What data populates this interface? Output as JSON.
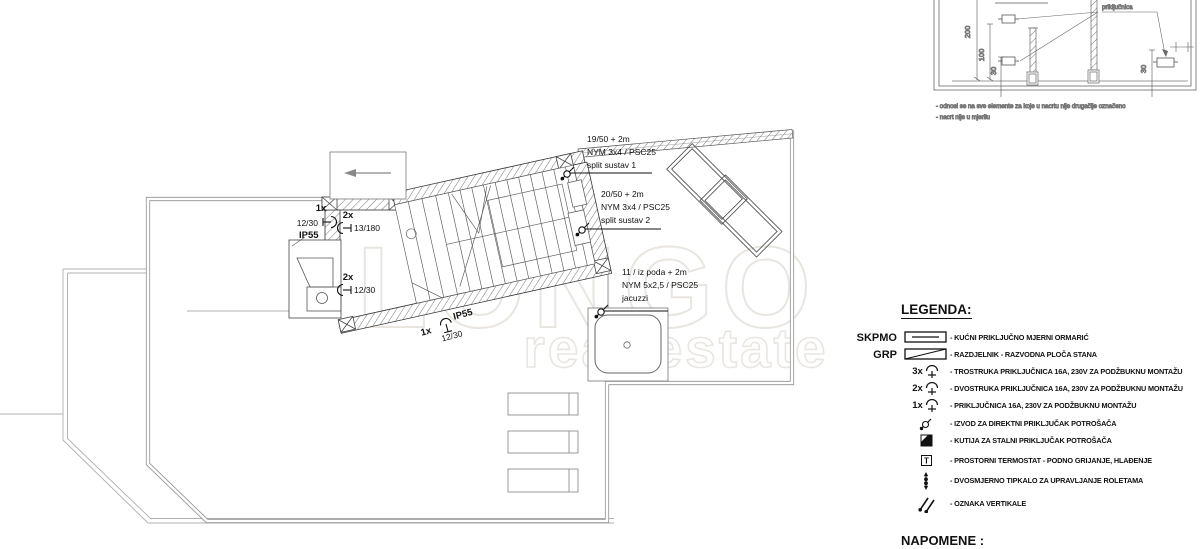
{
  "colors": {
    "line": "#444444",
    "terrace_edge": "#909090",
    "watermark": "#e9e6e1",
    "hatch": "#666666"
  },
  "watermark": {
    "line1": "LONGO",
    "line2": "real estate"
  },
  "plan": {
    "sockets": [
      {
        "count": "1x",
        "dim": "12/30",
        "ip": "IP55"
      },
      {
        "count": "2x",
        "dim": "13/180"
      },
      {
        "count": "2x",
        "dim": "12/30"
      },
      {
        "count": "1x",
        "dim": "12/30",
        "ip": "IP55"
      }
    ],
    "annotations": [
      {
        "l1": "19/50 + 2m",
        "l2": "NYM 3x4 / PSC25",
        "l3": "split sustav 1"
      },
      {
        "l1": "20/50 + 2m",
        "l2": "NYM 3x4 / PSC25",
        "l3": "split sustav 2"
      },
      {
        "l1": "11 / iz poda + 2m",
        "l2": "NYM 5x2,5 / PSC25",
        "l3": "jacuzzi"
      }
    ]
  },
  "detail": {
    "label_prikljucnica": "priključnica",
    "dims": {
      "d200": "200",
      "d100": "100",
      "d30_left": "30",
      "d30_right": "30"
    },
    "notes": [
      "- odnosi se na sve elemente za koje u nacrtu nije drugačije označeno",
      "- nacrt nije u mjerilu"
    ]
  },
  "legend": {
    "title": "LEGENDA:",
    "t_letter": "T",
    "napomene": "NAPOMENE :",
    "rows": [
      {
        "key": "SKPMO",
        "text": "- KUĆNI PRIKLJUČNO MJERNI ORMARIĆ"
      },
      {
        "key": "GRP",
        "text": "- RAZDJELNIK - RAZVODNA PLOČA STANA"
      },
      {
        "count": "3x",
        "text": "- TROSTRUKA PRIKLJUČNICA 16A, 230V ZA PODŽBUKNU MONTAŽU"
      },
      {
        "count": "2x",
        "text": "- DVOSTRUKA PRIKLJUČNICA 16A, 230V ZA PODŽBUKNU MONTAŽU"
      },
      {
        "count": "1x",
        "text": "- PRIKLJUČNICA 16A, 230V ZA PODŽBUKNU MONTAŽU"
      },
      {
        "text": "- IZVOD ZA DIREKTNI PRIKLJUČAK POTROŠAČA"
      },
      {
        "text": "- KUTIJA ZA STALNI PRIKLJUČAK POTROŠAČA"
      },
      {
        "text": "- PROSTORNI TERMOSTAT - PODNO GRIJANJE, HLAĐENJE"
      },
      {
        "text": "- DVOSMJERNO TIPKALO ZA UPRAVLJANJE ROLETAMA"
      },
      {
        "text": "- OZNAKA VERTIKALE"
      }
    ]
  }
}
